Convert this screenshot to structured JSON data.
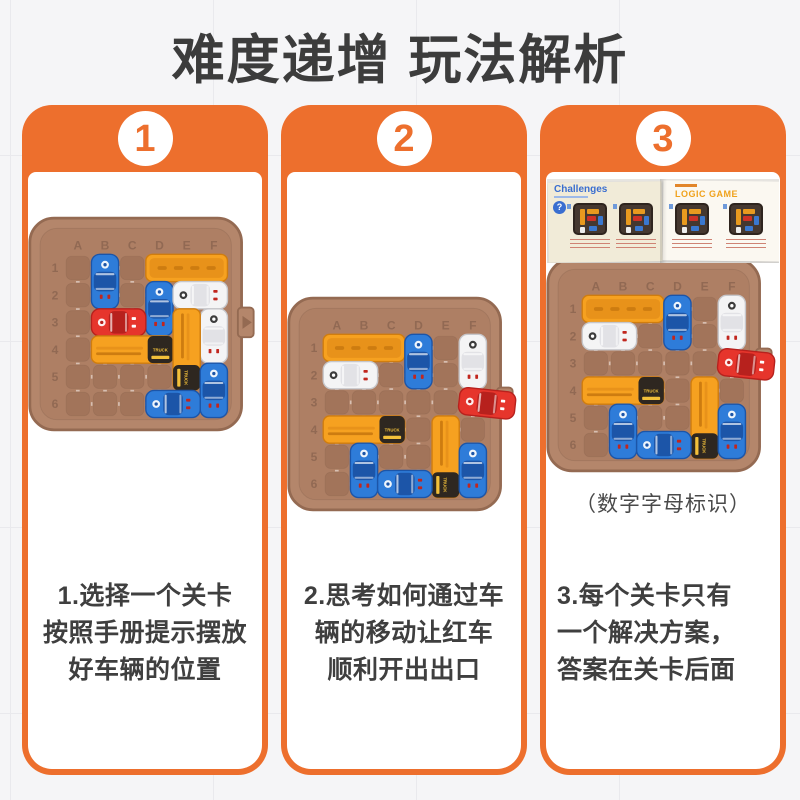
{
  "page": {
    "title": "难度递增 玩法解析",
    "accent": "#ed6f2d",
    "background": "#f5f5f7",
    "title_color": "#3c3c3c",
    "text_color": "#3f3f3f"
  },
  "board_labels": {
    "columns": [
      "A",
      "B",
      "C",
      "D",
      "E",
      "F"
    ],
    "rows": [
      "1",
      "2",
      "3",
      "4",
      "5",
      "6"
    ]
  },
  "truck_label": "TRUCK",
  "palette": {
    "board_base": "#b4866b",
    "board_floor": "#ae7f64",
    "board_cell": "#a2745a",
    "board_edge": "#946a52",
    "board_label": "#8a6450",
    "car_blue": "#2e7cd9",
    "car_blue_dark": "#1c55a8",
    "car_red": "#e6352c",
    "car_red_dark": "#b7211d",
    "car_white": "#f4f4f5",
    "car_white_stroke": "#c6c6ca",
    "car_white_cabin": "#e2e2e6",
    "mark_red": "#c1261e",
    "truck_orange": "#f6a120",
    "truck_orange_dark": "#d07d0e",
    "truck_orange_inner": "#e8921a",
    "truck_ridge": "#cd7c10",
    "cab_black": "#2e2720",
    "cab_yellow": "#f2c03a"
  },
  "steps": [
    {
      "number": "1",
      "lines": [
        "1.选择一个关卡",
        "按照手册提示摆放",
        "好车辆的位置"
      ],
      "board": {
        "exit_row": 3,
        "cars": [
          {
            "kind": "car",
            "color": "blue",
            "col": 2,
            "row": 1,
            "len": 2,
            "dir": "v"
          },
          {
            "kind": "ridge",
            "col": 4,
            "row": 1,
            "len": 3,
            "dir": "h"
          },
          {
            "kind": "car",
            "color": "blue",
            "col": 4,
            "row": 2,
            "len": 2,
            "dir": "v"
          },
          {
            "kind": "police",
            "col": 5,
            "row": 2,
            "len": 2,
            "dir": "h"
          },
          {
            "kind": "car",
            "color": "red",
            "col": 2,
            "row": 3,
            "len": 2,
            "dir": "h"
          },
          {
            "kind": "police",
            "col": 6,
            "row": 3,
            "len": 2,
            "dir": "v"
          },
          {
            "kind": "cab",
            "col": 2,
            "row": 4,
            "len": 3,
            "dir": "h"
          },
          {
            "kind": "cab",
            "col": 5,
            "row": 3,
            "len": 3,
            "dir": "v"
          },
          {
            "kind": "car",
            "color": "blue",
            "col": 6,
            "row": 5,
            "len": 2,
            "dir": "v"
          },
          {
            "kind": "car",
            "color": "blue",
            "col": 4,
            "row": 6,
            "len": 2,
            "dir": "h"
          }
        ]
      }
    },
    {
      "number": "2",
      "lines": [
        "2.思考如何通过车",
        "辆的移动让红车",
        "顺利开出出口"
      ],
      "board": {
        "exit_row": 3,
        "cars": [
          {
            "kind": "ridge",
            "col": 1,
            "row": 1,
            "len": 3,
            "dir": "h"
          },
          {
            "kind": "car",
            "color": "blue",
            "col": 4,
            "row": 1,
            "len": 2,
            "dir": "v"
          },
          {
            "kind": "police",
            "col": 6,
            "row": 1,
            "len": 2,
            "dir": "v"
          },
          {
            "kind": "police",
            "col": 1,
            "row": 2,
            "len": 2,
            "dir": "h"
          },
          {
            "kind": "cab",
            "col": 1,
            "row": 4,
            "len": 3,
            "dir": "h"
          },
          {
            "kind": "cab",
            "col": 5,
            "row": 4,
            "len": 3,
            "dir": "v"
          },
          {
            "kind": "car",
            "color": "blue",
            "col": 2,
            "row": 5,
            "len": 2,
            "dir": "v"
          },
          {
            "kind": "car",
            "color": "blue",
            "col": 3,
            "row": 6,
            "len": 2,
            "dir": "h"
          },
          {
            "kind": "car",
            "color": "blue",
            "col": 6,
            "row": 5,
            "len": 2,
            "dir": "v"
          },
          {
            "kind": "car",
            "color": "red",
            "row": 3,
            "len": 2,
            "dir": "h",
            "exit": true
          }
        ]
      }
    },
    {
      "number": "3",
      "lines": [
        "3.每个关卡只有",
        "一个解决方案，",
        "答案在关卡后面"
      ],
      "caption": "（数字字母标识）",
      "booklet": {
        "left_title": "Challenges",
        "right_title": "LOGIC GAME",
        "question_mark": "?"
      },
      "board": {
        "exit_row": 3,
        "cars": [
          {
            "kind": "ridge",
            "col": 1,
            "row": 1,
            "len": 3,
            "dir": "h"
          },
          {
            "kind": "car",
            "color": "blue",
            "col": 4,
            "row": 1,
            "len": 2,
            "dir": "v"
          },
          {
            "kind": "police",
            "col": 6,
            "row": 1,
            "len": 2,
            "dir": "v"
          },
          {
            "kind": "police",
            "col": 1,
            "row": 2,
            "len": 2,
            "dir": "h"
          },
          {
            "kind": "cab",
            "col": 1,
            "row": 4,
            "len": 3,
            "dir": "h"
          },
          {
            "kind": "cab",
            "col": 5,
            "row": 4,
            "len": 3,
            "dir": "v"
          },
          {
            "kind": "car",
            "color": "blue",
            "col": 2,
            "row": 5,
            "len": 2,
            "dir": "v"
          },
          {
            "kind": "car",
            "color": "blue",
            "col": 3,
            "row": 6,
            "len": 2,
            "dir": "h"
          },
          {
            "kind": "car",
            "color": "blue",
            "col": 6,
            "row": 5,
            "len": 2,
            "dir": "v"
          },
          {
            "kind": "car",
            "color": "red",
            "row": 3,
            "len": 2,
            "dir": "h",
            "exit": true
          }
        ]
      }
    }
  ]
}
